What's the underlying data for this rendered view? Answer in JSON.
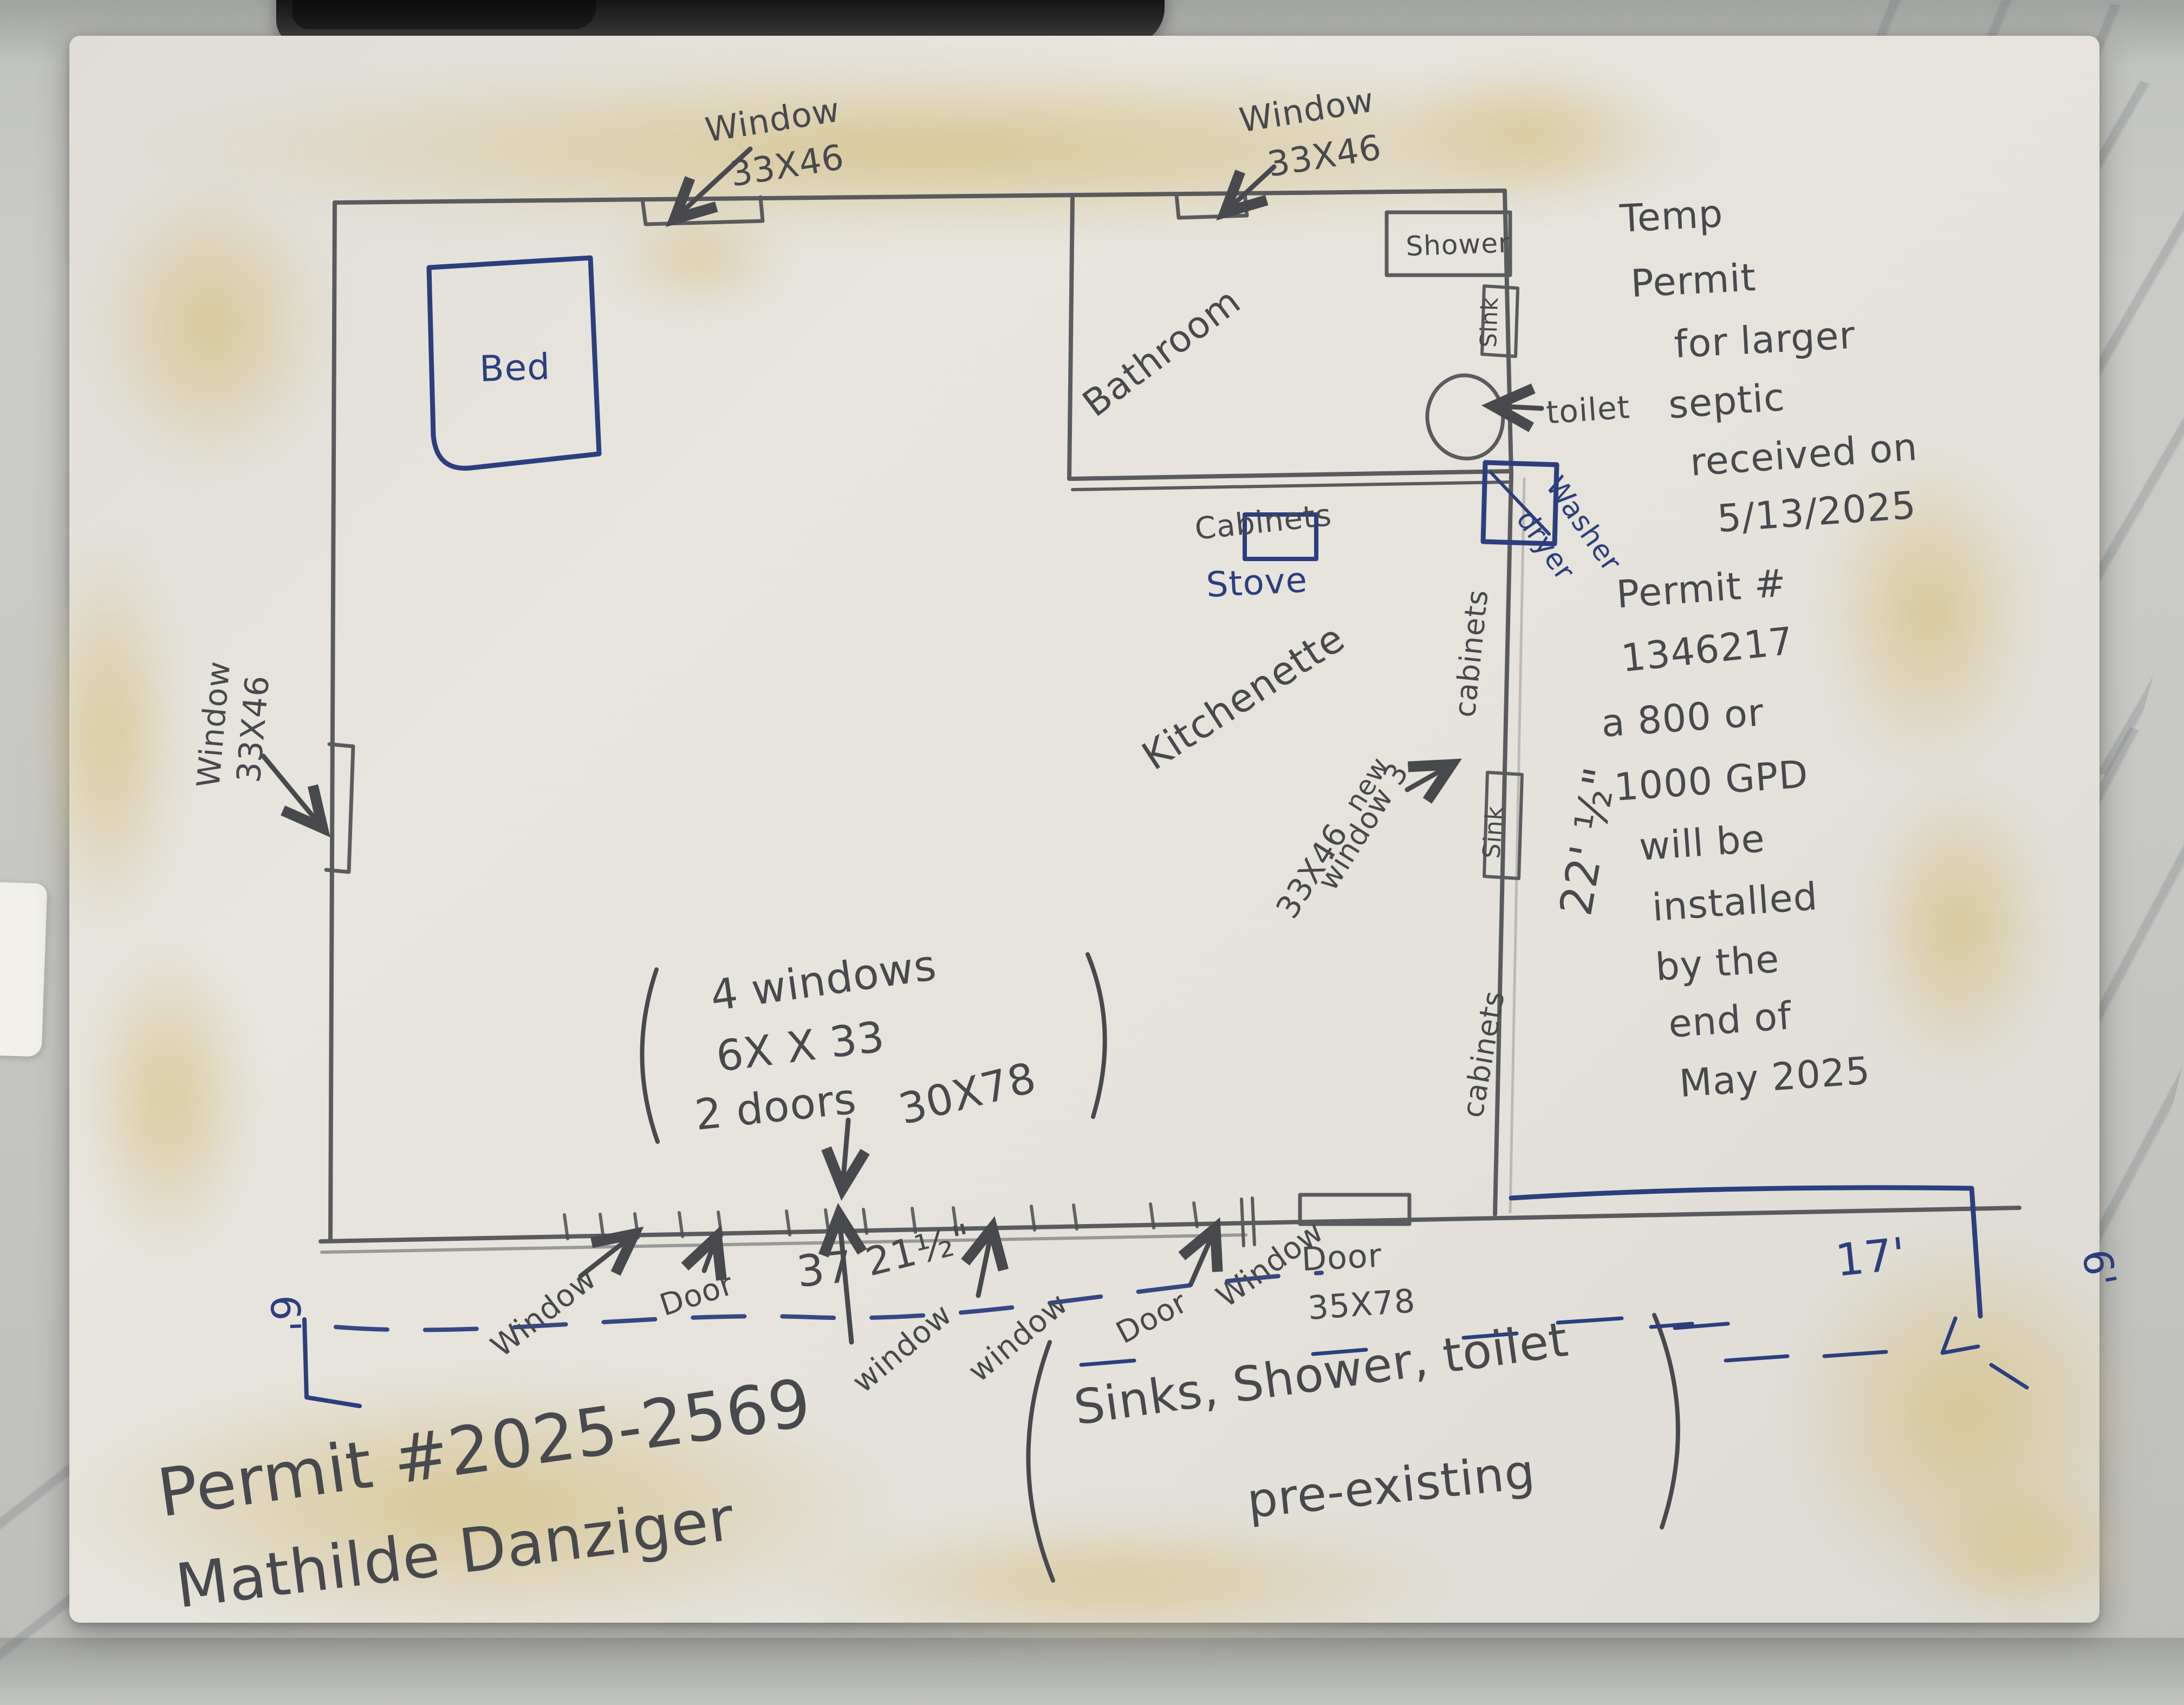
{
  "colors": {
    "pencil": "#47494d",
    "pen": "#2c3e7e",
    "paper": "#e4e2da",
    "stain": "#d6c18a",
    "marble": "#c6c7c3",
    "top_object": "#141416"
  },
  "rooms": {
    "bathroom": "Bathroom",
    "kitchenette": "Kitchenette"
  },
  "fixtures": {
    "bed": "Bed",
    "shower": "Shower",
    "sink": "Sink",
    "toilet": "toilet",
    "cabinets": "Cabinets",
    "cabinets_side": "cabinets",
    "stove": "Stove",
    "washer": "Washer",
    "dryer": "dryer"
  },
  "windows": {
    "label": "Window",
    "label_lc": "window",
    "size": "33X46"
  },
  "openings": {
    "door": "Door",
    "door_size": "35X78"
  },
  "dims": {
    "d37": "37",
    "d21": "21½\"",
    "d22": "22' ½\"",
    "d17": "17'",
    "d6": "6'"
  },
  "kitchen_note": [
    "new",
    "window 3",
    "33X46"
  ],
  "notes": {
    "summary": [
      "4 windows",
      "6X X 33",
      "2 doors",
      "30X78"
    ],
    "septic": [
      "Temp",
      "Permit",
      "for larger",
      "septic",
      "received on",
      "5/13/2025"
    ],
    "permit": [
      "Permit #",
      "1346217",
      "a 800 or",
      "1000 GPD",
      "will be",
      "installed",
      "by the",
      "end of",
      "May 2025"
    ],
    "preexisting": [
      "Sinks, Shower, toilet",
      "pre-existing"
    ],
    "footer": [
      "Permit #2025-2569",
      "Mathilde Danziger"
    ]
  }
}
